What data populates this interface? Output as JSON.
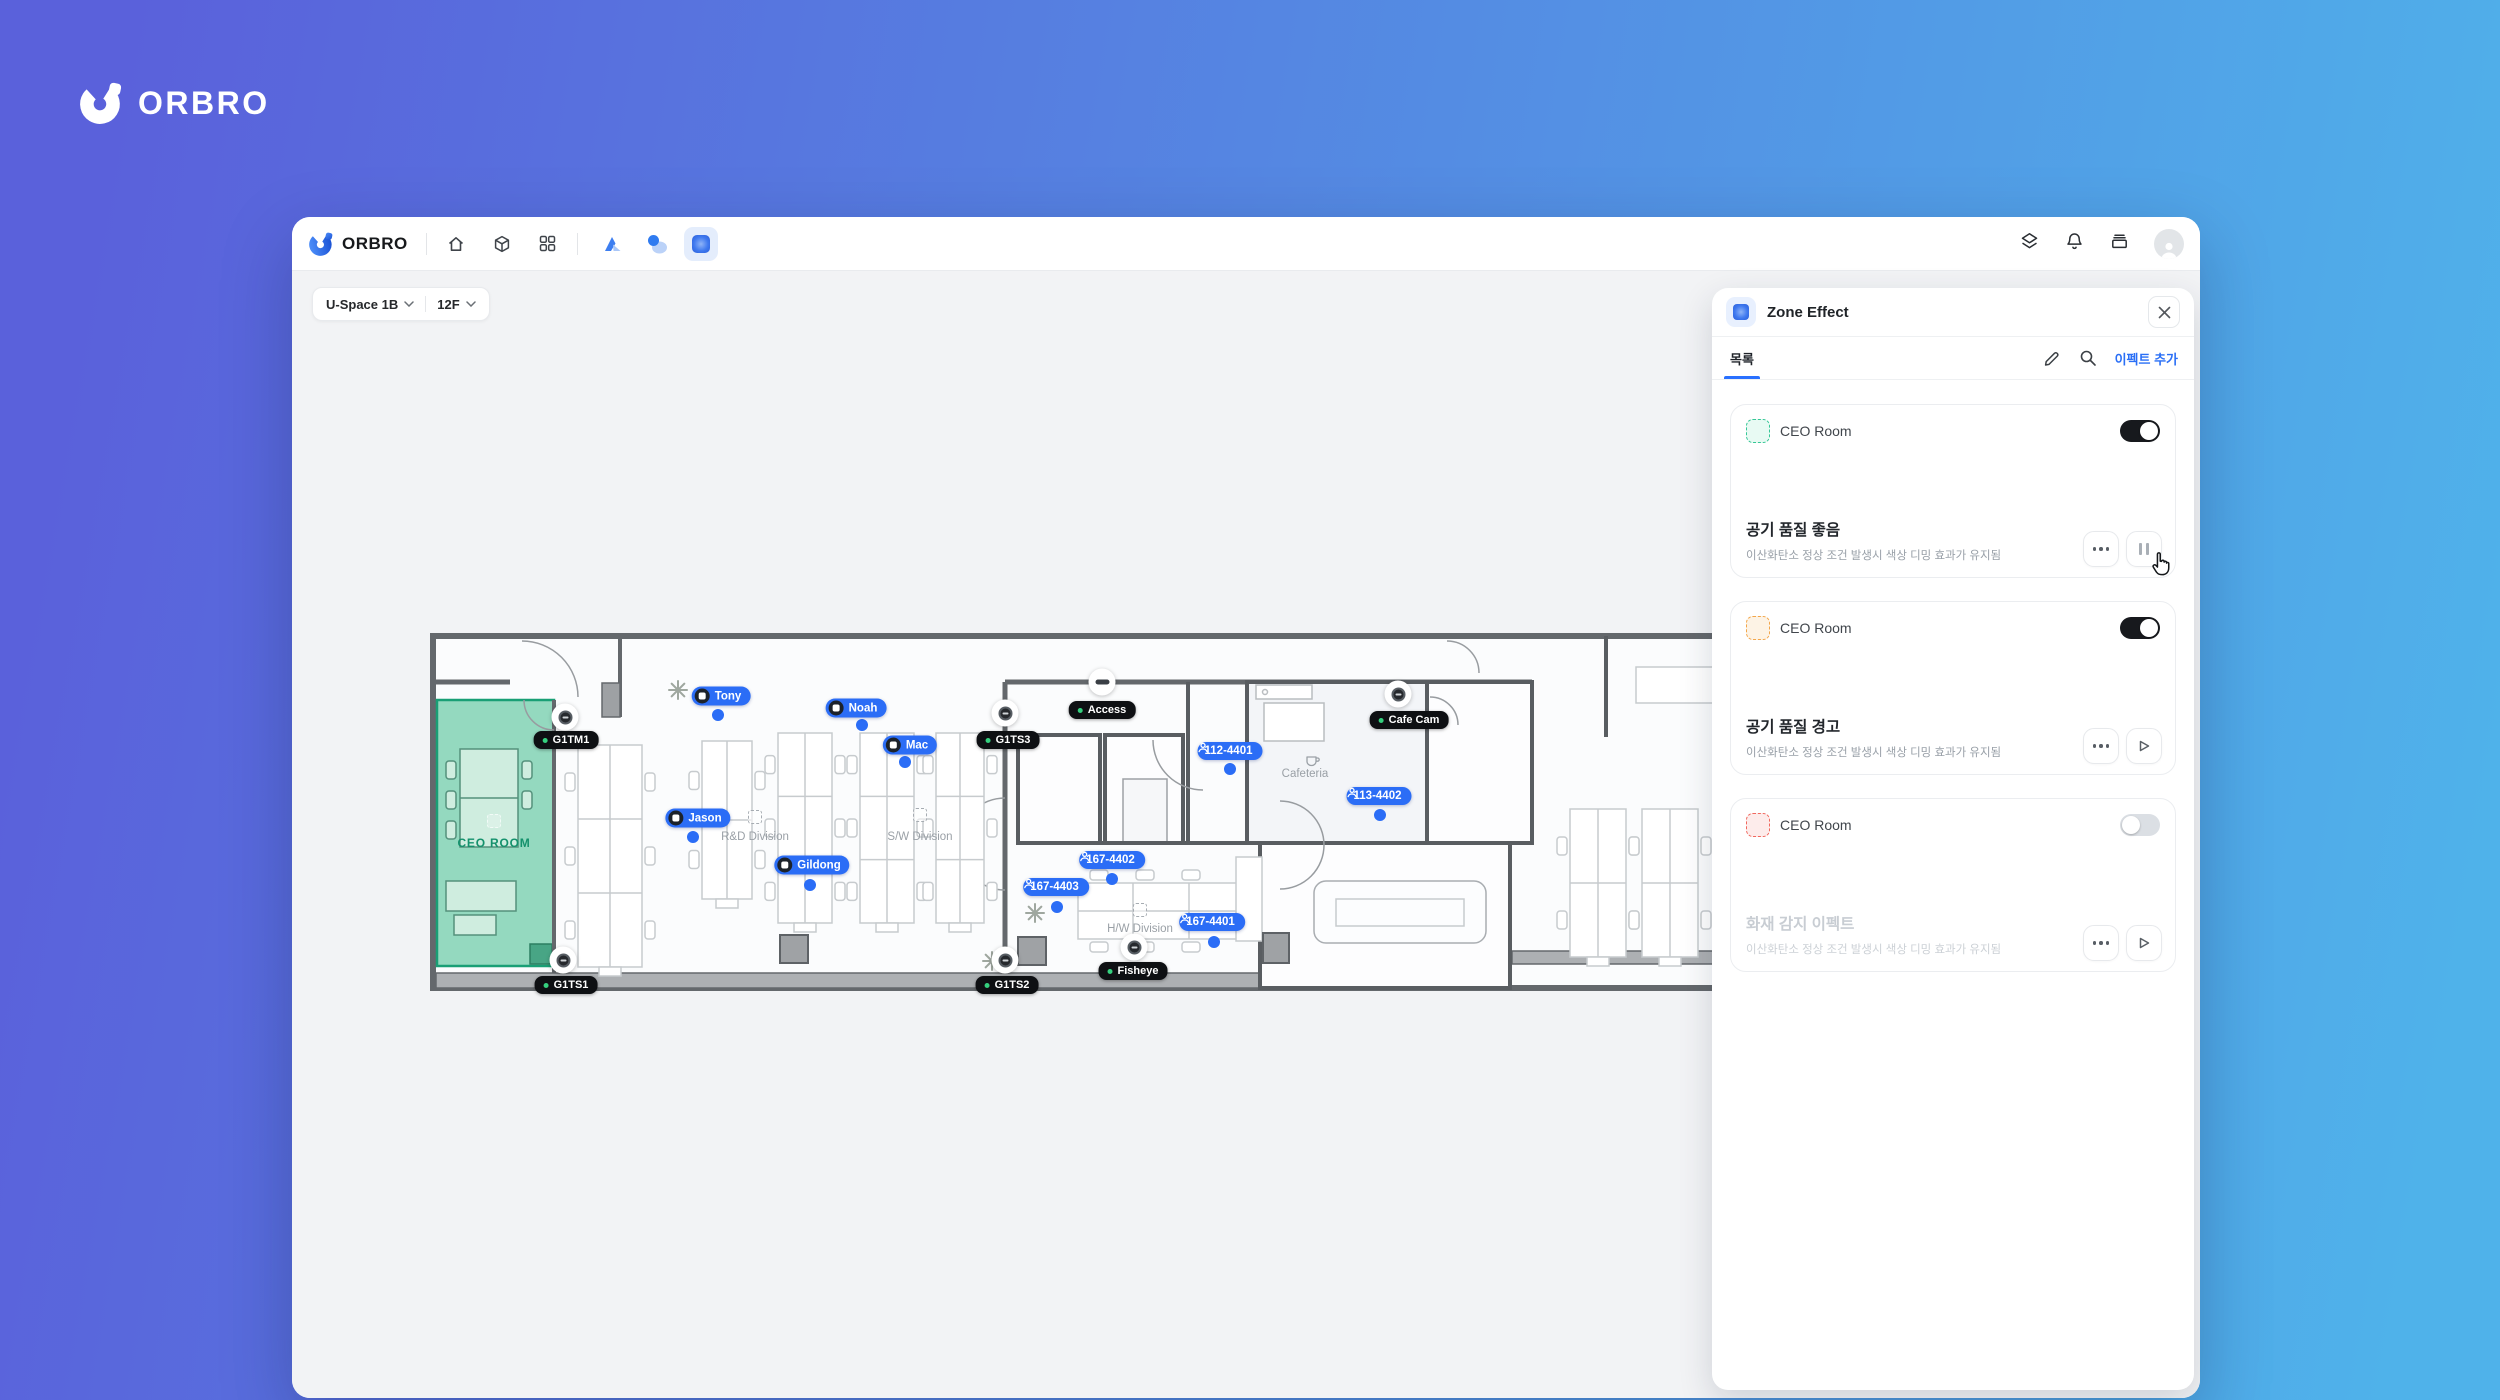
{
  "brand": {
    "name": "ORBRO"
  },
  "titlebar": {
    "brand": "ORBRO"
  },
  "selectors": {
    "site": "U-Space 1B",
    "floor": "12F"
  },
  "panel": {
    "title": "Zone Effect",
    "tab": "목록",
    "add_button": "이펙트 추가",
    "accent_color": "#2970FF",
    "cards": [
      {
        "zone": "CEO Room",
        "zone_color": "green",
        "enabled": true,
        "title": "공기 품질 좋음",
        "desc": "이산화탄소 정상 조건 발생시 색상 디밍 효과가 유지됨",
        "action": "pause",
        "disabled": false
      },
      {
        "zone": "CEO Room",
        "zone_color": "orange",
        "enabled": true,
        "title": "공기 품질 경고",
        "desc": "이산화탄소 정상 조건 발생시 색상 디밍 효과가 유지됨",
        "action": "play",
        "disabled": false
      },
      {
        "zone": "CEO Room",
        "zone_color": "red",
        "enabled": false,
        "title": "화재 감지 이펙트",
        "desc": "이산화탄소 정상 조건 발생시 색상 디밍 효과가 유지됨",
        "action": "play",
        "disabled": true
      }
    ]
  },
  "floorplan": {
    "tag_color": "#2B6DF6",
    "person_tags": [
      {
        "label": "Tony",
        "x": 291,
        "y": 63,
        "dot_x": 288,
        "dot_y": 82
      },
      {
        "label": "Noah",
        "x": 426,
        "y": 75,
        "dot_x": 432,
        "dot_y": 92
      },
      {
        "label": "Mac",
        "x": 480,
        "y": 112,
        "dot_x": 475,
        "dot_y": 129
      },
      {
        "label": "Jason",
        "x": 268,
        "y": 185,
        "dot_x": 263,
        "dot_y": 204
      },
      {
        "label": "Gildong",
        "x": 382,
        "y": 232,
        "dot_x": 380,
        "dot_y": 252
      }
    ],
    "sensor_tags": [
      {
        "label": "112-4401",
        "x": 800,
        "y": 118,
        "dot_x": 800,
        "dot_y": 136
      },
      {
        "label": "113-4402",
        "x": 949,
        "y": 163,
        "dot_x": 950,
        "dot_y": 182
      },
      {
        "label": "167-4402",
        "x": 682,
        "y": 227,
        "dot_x": 682,
        "dot_y": 246
      },
      {
        "label": "167-4403",
        "x": 626,
        "y": 254,
        "dot_x": 627,
        "dot_y": 274
      },
      {
        "label": "167-4401",
        "x": 782,
        "y": 289,
        "dot_x": 784,
        "dot_y": 309
      }
    ],
    "device_labels": [
      {
        "label": "G1TM1",
        "x": 136,
        "y": 107,
        "cam_x": 135,
        "cam_y": 84,
        "type": "cam"
      },
      {
        "label": "G1TS1",
        "x": 136,
        "y": 352,
        "cam_x": 133,
        "cam_y": 327,
        "type": "cam"
      },
      {
        "label": "G1TS3",
        "x": 578,
        "y": 107,
        "cam_x": 575,
        "cam_y": 80,
        "type": "cam"
      },
      {
        "label": "G1TS2",
        "x": 577,
        "y": 352,
        "cam_x": 575,
        "cam_y": 327,
        "type": "cam"
      },
      {
        "label": "Fisheye",
        "x": 703,
        "y": 338,
        "cam_x": 704,
        "cam_y": 314,
        "type": "cam"
      },
      {
        "label": "Cafe Cam",
        "x": 979,
        "y": 87,
        "cam_x": 968,
        "cam_y": 61,
        "type": "cam"
      },
      {
        "label": "Access",
        "x": 672,
        "y": 77,
        "cam_x": 672,
        "cam_y": 49,
        "type": "access"
      }
    ],
    "area_labels": [
      {
        "label": "CEO ROOM",
        "x": 64,
        "y": 210,
        "icon_y": 188,
        "style": "ceo"
      },
      {
        "label": "R&D Division",
        "x": 325,
        "y": 204,
        "icon_y": 184,
        "style": "div"
      },
      {
        "label": "S/W Division",
        "x": 490,
        "y": 204,
        "icon_y": 182,
        "style": "div"
      },
      {
        "label": "H/W Division",
        "x": 710,
        "y": 296,
        "icon_y": 277,
        "style": "div"
      },
      {
        "label": "Cafeteria",
        "x": 875,
        "y": 141,
        "icon_y": 122,
        "style": "cafe"
      }
    ]
  }
}
